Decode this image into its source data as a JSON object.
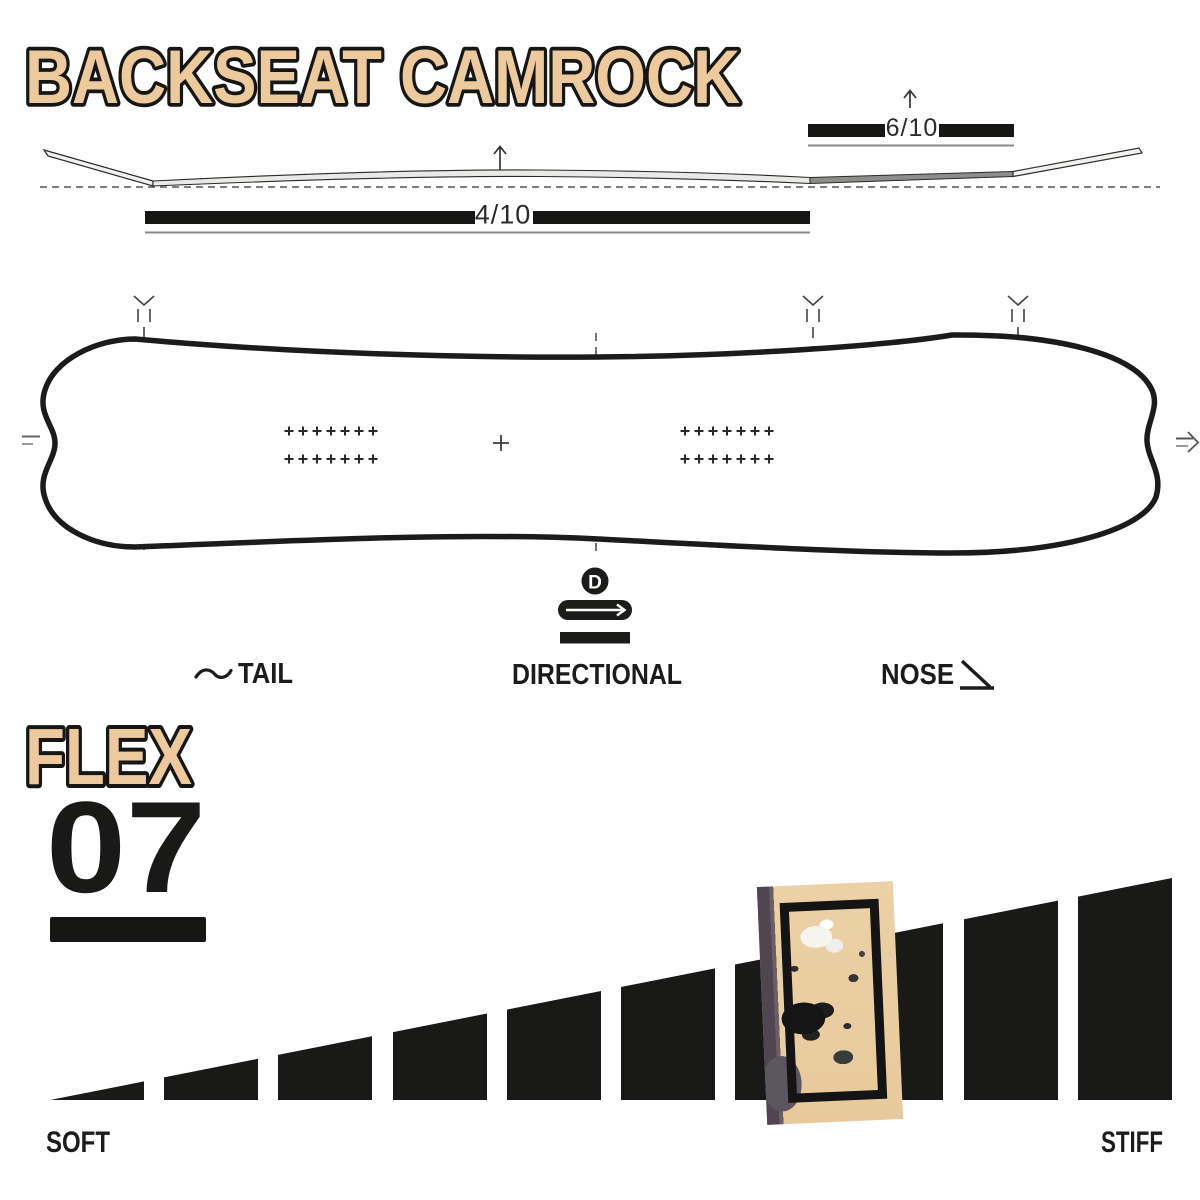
{
  "title": "BACKSEAT CAMROCK",
  "profile_diagram": {
    "camber_rating": "4/10",
    "rocker_rating": "6/10"
  },
  "board_diagram": {
    "directional_letter": "D"
  },
  "legend": {
    "tail_label": "TAIL",
    "shape_label": "DIRECTIONAL",
    "nose_label": "NOSE"
  },
  "flex_section": {
    "heading": "FLEX",
    "value": "07",
    "soft_label": "SOFT",
    "stiff_label": "STIFF"
  },
  "colors": {
    "tan": "#ecca9e",
    "ink": "#1b1b19",
    "bar_black": "#191917",
    "profile_light": "#e9e9e7",
    "profile_dark": "#8d8d8b",
    "highlight_purple": "#514551"
  },
  "chart_data": {
    "type": "bar",
    "title": "Flex rating ramp",
    "categories": [
      1,
      2,
      3,
      4,
      5,
      6,
      7,
      8,
      9,
      10
    ],
    "values": [
      1,
      2,
      3,
      4,
      5,
      6,
      7,
      8,
      9,
      10
    ],
    "flex_value": 7,
    "highlighted_bar": 7,
    "xlabel_left": "SOFT",
    "xlabel_right": "STIFF",
    "legend_position": "none",
    "grid": false
  }
}
